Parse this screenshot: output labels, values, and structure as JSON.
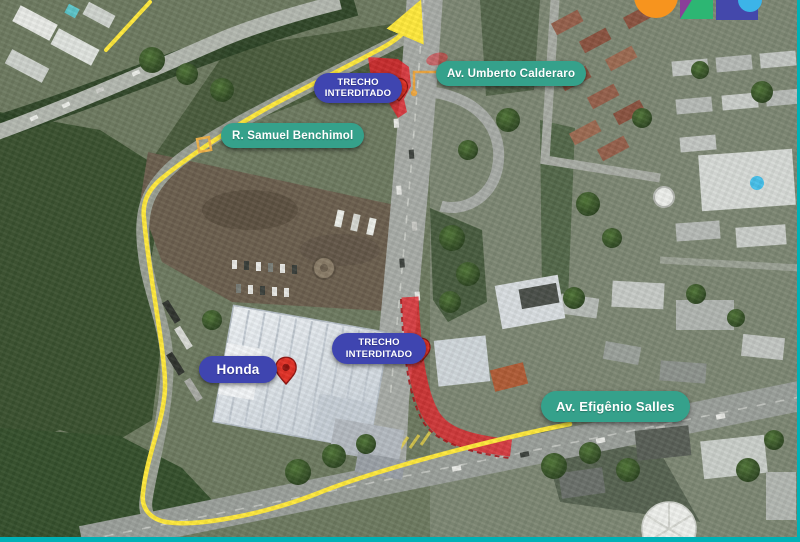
{
  "labels": {
    "street_umberto": "Av. Umberto Calderaro",
    "street_samuel": "R. Samuel Benchimol",
    "street_efigenio": "Av. Efigênio Salles",
    "poi_honda": "Honda"
  },
  "closure_badge": {
    "line1": "TRECHO",
    "line2": "INTERDITADO",
    "count": 2
  },
  "markers": {
    "location_pin_count": 3,
    "pin_color": "#e23126",
    "connector_color": "#eda63f"
  },
  "route": {
    "type": "detour-route-line",
    "color": "#ffe93b",
    "arrow_direction": "up-right"
  },
  "closure_zones": {
    "count": 2,
    "color": "#e62129"
  },
  "frame": {
    "bottom_bar_color": "#00b1b6",
    "right_bar_color": "#00b1b6"
  },
  "logo": {
    "description": "government-logo-fragment",
    "colors": [
      "#f7941e",
      "#8a3f99",
      "#2db673",
      "#4448ab",
      "#3cb4e8"
    ]
  },
  "pill_colors": {
    "street": "#35a18b",
    "closure": "#3f45b0"
  }
}
